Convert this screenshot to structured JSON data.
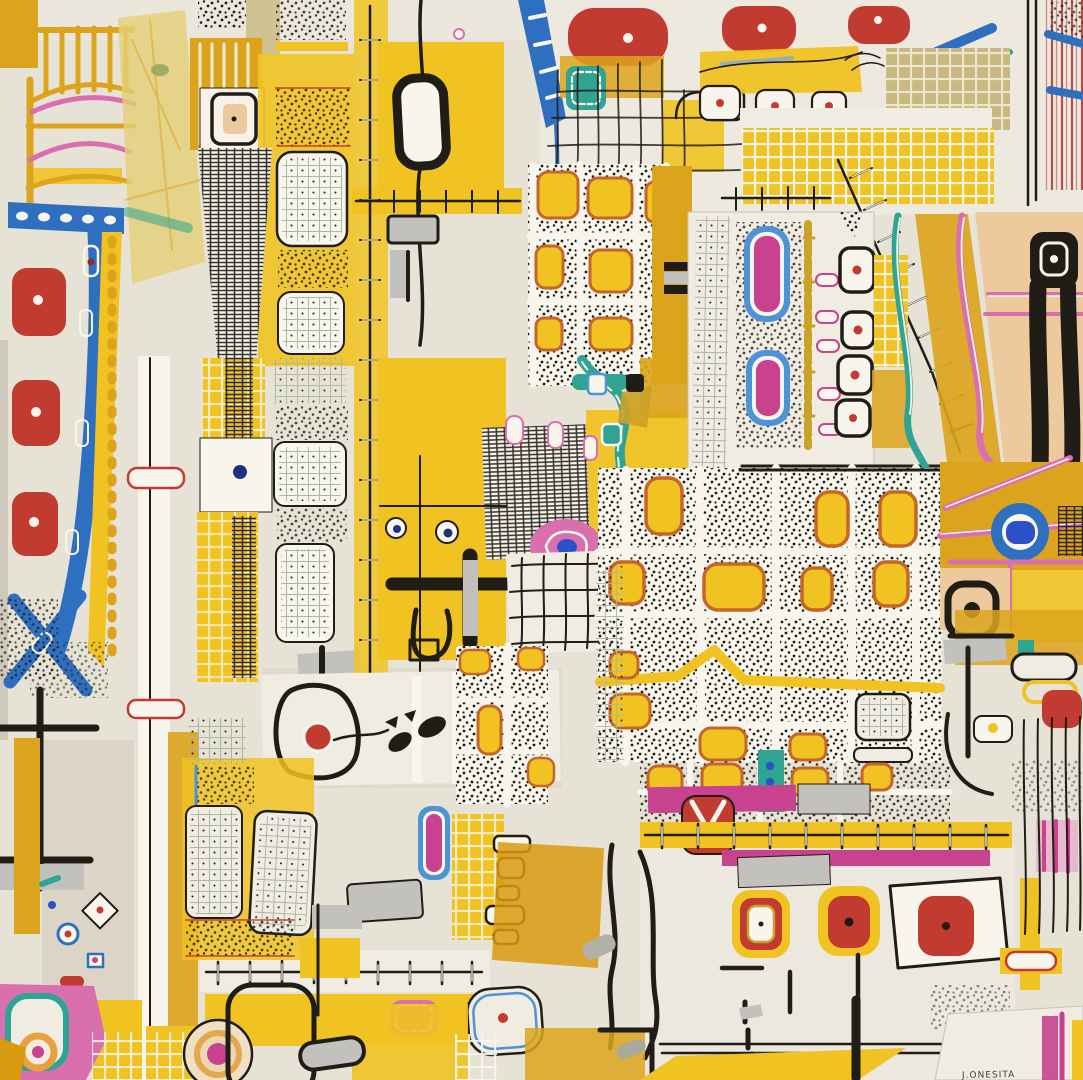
{
  "artwork": {
    "signature": "J.ONESITA",
    "kind": "abstract mixed-media paper collage"
  },
  "palette": {
    "paper": "#E7E2D6",
    "paper2": "#F0ECE2",
    "paper3": "#D9D2C3",
    "white": "#F8F5EC",
    "yellow": "#F0C322",
    "ochre": "#DCA41C",
    "amber": "#D99A10",
    "tape": "#E4CF74",
    "red": "#C23B31",
    "magenta": "#C8428F",
    "pink": "#D96FAE",
    "orange": "#C4662A",
    "blue": "#2F6FC0",
    "skyblue": "#4E93D4",
    "cobalt": "#2B50C8",
    "teal": "#2FA493",
    "gold": "#C9A227",
    "silver": "#C2C1BD",
    "ink": "#201C16",
    "peach": "#EDC99E",
    "khaki": "#C9B97E",
    "sage": "#A9B8A2"
  }
}
